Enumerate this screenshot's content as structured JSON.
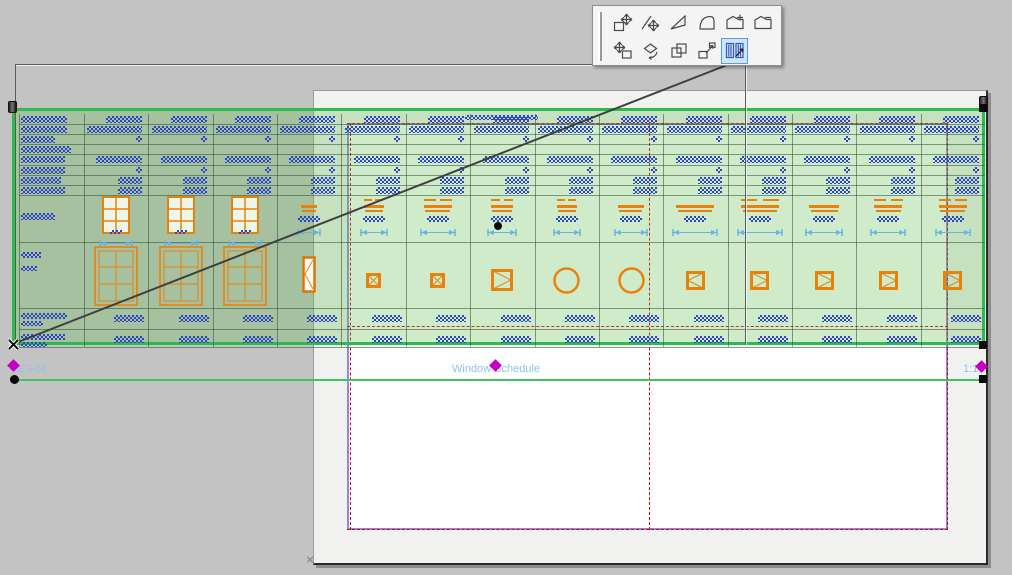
{
  "palette": {
    "row1": [
      "move-node-icon",
      "offset-edge-icon",
      "offset-all-edges-icon",
      "curve-edge-icon",
      "add-to-polygon-icon",
      "subtract-from-polygon-icon"
    ],
    "row2": [
      "drag-icon",
      "rotate-icon",
      "multiply-icon",
      "resize-icon",
      "fit-frame-to-drawing-icon"
    ],
    "highlighted": "fit-frame-to-drawing-icon"
  },
  "page": {
    "grid_labels": [
      "A1",
      "A2",
      "B1",
      "B2"
    ],
    "corner_mark": "×"
  },
  "drawing": {
    "name": "IES-04",
    "title": "Window Schedule",
    "scale": "1:1",
    "table": {
      "data_columns": 14,
      "thin_rows": [
        {
          "header_w": 46,
          "data_w": 36
        },
        {
          "header_w": 46,
          "data_w": 55
        },
        {
          "header_w": 34,
          "data_w": 6
        },
        {
          "header_w": 50,
          "data_w": 0
        },
        {
          "header_w": 44,
          "data_w": 46
        },
        {
          "header_w": 44,
          "data_w": 6
        },
        {
          "header_w": 40,
          "data_w": 24
        },
        {
          "header_w": 44,
          "data_w": 24
        }
      ],
      "picture_row1": {
        "header_bar": 34,
        "window_cols": [
          0,
          1,
          2
        ],
        "plan_symbols": [
          {
            "col": 3,
            "dash": 0,
            "w": 16
          },
          {
            "col": 4,
            "dash": 1,
            "w": 20
          },
          {
            "col": 5,
            "dash": 1,
            "w": 28
          },
          {
            "col": 6,
            "dash": 1,
            "w": 22
          },
          {
            "col": 7,
            "dash": 1,
            "w": 20
          },
          {
            "col": 8,
            "dash": 0,
            "w": 26
          },
          {
            "col": 9,
            "dash": 0,
            "w": 38
          },
          {
            "col": 10,
            "dash": 1,
            "w": 38
          },
          {
            "col": 11,
            "dash": 0,
            "w": 30
          },
          {
            "col": 12,
            "dash": 1,
            "w": 28
          },
          {
            "col": 13,
            "dash": 1,
            "w": 28
          }
        ]
      },
      "picture_row2": {
        "header_bars": [
          20,
          16
        ],
        "casement_cols": [
          0,
          1,
          2
        ],
        "door_col": 3,
        "symbols": [
          {
            "col": 4,
            "type": "x",
            "size": 15
          },
          {
            "col": 5,
            "type": "x",
            "size": 15
          },
          {
            "col": 6,
            "type": "gt",
            "size": 22
          },
          {
            "col": 7,
            "type": "circle",
            "size": 27
          },
          {
            "col": 8,
            "type": "circle",
            "size": 27
          },
          {
            "col": 9,
            "type": "lt",
            "size": 19
          },
          {
            "col": 10,
            "type": "gt",
            "size": 19
          },
          {
            "col": 11,
            "type": "gt",
            "size": 19
          },
          {
            "col": 12,
            "type": "gt",
            "size": 19
          },
          {
            "col": 13,
            "type": "gt",
            "size": 19
          }
        ]
      },
      "text_rows": {
        "header_bars": [
          [
            46,
            22
          ],
          [
            44,
            26
          ]
        ],
        "data_w": 30
      }
    }
  },
  "colors": {
    "pasteboard": "#c3c3c3",
    "selection_green": "#2dbb4e",
    "title_green": "#3ec45f",
    "orange": "#e8820c",
    "greek_blue": "#2b45c4",
    "dim_blue": "#6ab4e4",
    "printable_blue": "#8a8ae2",
    "grid_red": "#dd0000",
    "label_gray": "#d6d6d6",
    "hotspot_magenta": "#c400c4",
    "title_text_blue": "#8ec3ea"
  }
}
